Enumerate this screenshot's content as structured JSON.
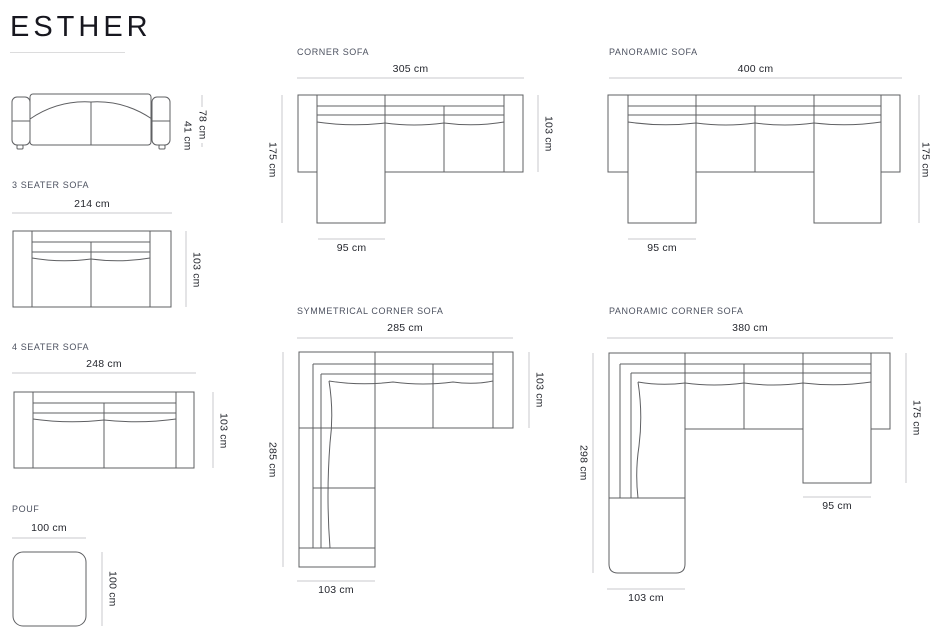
{
  "title": "ESTHER",
  "sections": {
    "front_view": {
      "dim_total_height": "78 cm",
      "dim_seat_height": "41 cm"
    },
    "three_seater": {
      "label": "3 SEATER SOFA",
      "dim_width": "214 cm",
      "dim_depth": "103 cm"
    },
    "four_seater": {
      "label": "4 SEATER SOFA",
      "dim_width": "248 cm",
      "dim_depth": "103 cm"
    },
    "pouf": {
      "label": "POUF",
      "dim_width": "100 cm",
      "dim_depth": "100 cm"
    },
    "corner": {
      "label": "CORNER SOFA",
      "dim_width": "305 cm",
      "dim_side": "175 cm",
      "dim_depth": "103 cm",
      "dim_chaise": "95 cm"
    },
    "panoramic": {
      "label": "PANORAMIC SOFA",
      "dim_width": "400 cm",
      "dim_side": "175 cm",
      "dim_chaise": "95 cm"
    },
    "symmetrical_corner": {
      "label": "SYMMETRICAL CORNER SOFA",
      "dim_width": "285 cm",
      "dim_side": "285 cm",
      "dim_depth": "103 cm",
      "dim_bottom": "103 cm"
    },
    "panoramic_corner": {
      "label": "PANORAMIC CORNER SOFA",
      "dim_width": "380 cm",
      "dim_side": "298 cm",
      "dim_right": "175 cm",
      "dim_chaise": "95 cm",
      "dim_bottom": "103 cm"
    }
  },
  "colors": {
    "drawing_line": "#5f6063",
    "dimension_line": "#c9c9cc",
    "dimension_text": "#25272e",
    "label_text": "#4d5260",
    "title_text": "#17171f"
  }
}
